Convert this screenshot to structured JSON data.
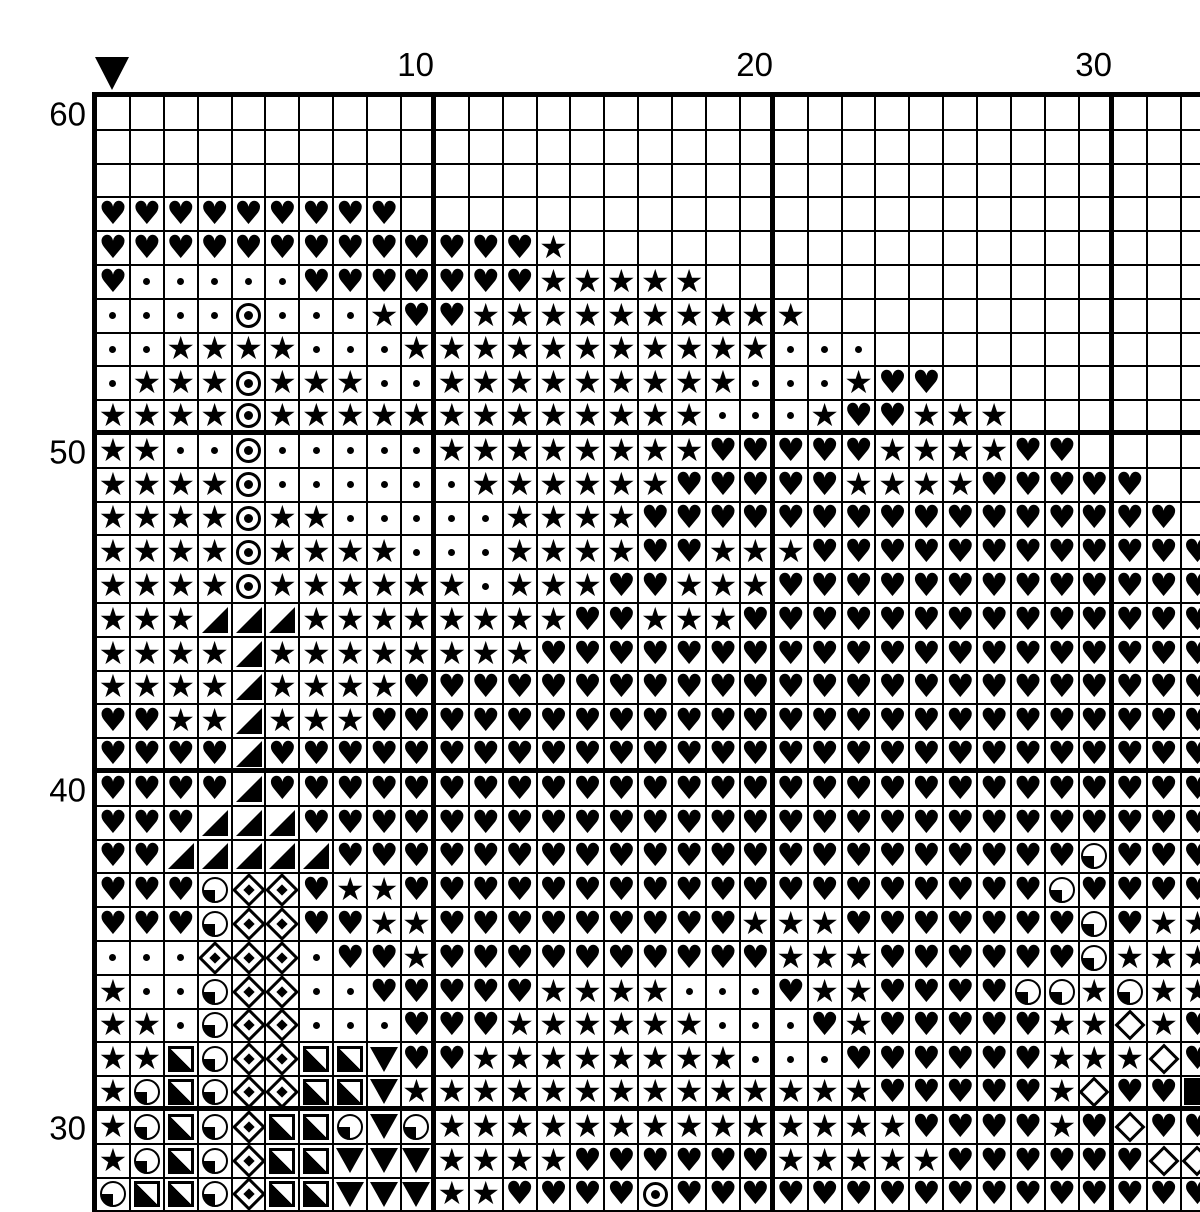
{
  "meta": {
    "title": "Cross-stitch pattern chart",
    "colors": {
      "ink": "#000000",
      "paper": "#ffffff"
    }
  },
  "axis": {
    "column_labels": [
      {
        "text": "10",
        "col": 10
      },
      {
        "text": "20",
        "col": 20
      },
      {
        "text": "30",
        "col": 30
      }
    ],
    "row_labels": [
      {
        "text": "60",
        "row_index": 0
      },
      {
        "text": "50",
        "row_index": 10
      },
      {
        "text": "40",
        "row_index": 20
      },
      {
        "text": "30",
        "row_index": 30
      }
    ]
  },
  "marker": {
    "name": "start-marker",
    "shape": "down-triangle",
    "above_col": 1
  },
  "symbols": {
    "h": {
      "name": "heart-symbol",
      "glyph": "♥"
    },
    "s": {
      "name": "star-symbol",
      "glyph": "★"
    },
    "d": {
      "name": "dot-symbol"
    },
    "o": {
      "name": "circled-dot-symbol"
    },
    "t": {
      "name": "lower-right-triangle-symbol"
    },
    "q": {
      "name": "quarter-circle-symbol"
    },
    "D": {
      "name": "diamond-with-center-symbol"
    },
    "e": {
      "name": "open-diamond-symbol"
    },
    "S": {
      "name": "half-square-symbol"
    },
    "v": {
      "name": "down-triangle-symbol"
    },
    "f": {
      "name": "solid-square-symbol"
    },
    ".": {
      "name": "empty"
    }
  },
  "grid": {
    "cols": 33,
    "rows": 33,
    "thick_every": 10,
    "rows_data": [
      ".................................",
      ".................................",
      ".................................",
      "hhhhhhhhh........................",
      "hhhhhhhhhhhhhs...................",
      "hdddddhhhhhhhsssss...............",
      "ddddodddshhssssssssss............",
      "ddssssdddsssssssssssddd..........",
      "dsssosssddsssssssssdddshh........",
      "ssssosssssssssssssdddshhsss......",
      "ssddodddddsssssssshhhhhsssshh....",
      "ssssoddddddsssssshhhhhsssshhhhh..",
      "ssssossdddddsssshhhhhhhhhhhhhhhh.",
      "ssssossssdddsssshhssshhhhhhhhhhhh",
      "ssssossssssdssshhssshhhhhhhhhhhhh",
      "ssstttsssssssshhssshhhhhhhhhhhhhh",
      "sssstsssssssshhhhhhhhhhhhhhhhhhhh",
      "sssstsssshhhhhhhhhhhhhhhhhhhhhhhh",
      "hhsstssshhhhhhhhhhhhhhhhhhhhhhhhh",
      "hhhhthhhhhhhhhhhhhhhhhhhhhhhhhhhh",
      "hhhhthhhhhhhhhhhhhhhhhhhhhhhhhhhh",
      "hhhttthhhhhhhhhhhhhhhhhhhhhhhhhhh",
      "hhttttthhhhhhhhhhhhhhhhhhhhhhqhhhh",
      "hhhqDDhsshhhhhhhhhhhhhhhhhhhqhhhh",
      "hhhqDDhhsshhhhhhhhhssshhhhhhhqhss",
      "dddDDDdhhshhhhhhhhhhssshhhhhhqsss",
      "sddqDDddhhhhhssssdddhsshhhhqqsqss",
      "ssdqDDdddhhhssssssdddhshhhhhssesh",
      "ssSqDDSSvhhssssssssdddhhhhhhssseh",
      "sqSqDDSSvsssssssssssssshhhhhsehhf",
      "sqSqDSSqvqsssssssssssssshhhhshehh",
      "sqSqDSSvvvsssshhhhhhssssshhhhhhee",
      "qSSqDSSvvvsshhhhohhhhhhhhhhhhhhhh"
    ]
  }
}
